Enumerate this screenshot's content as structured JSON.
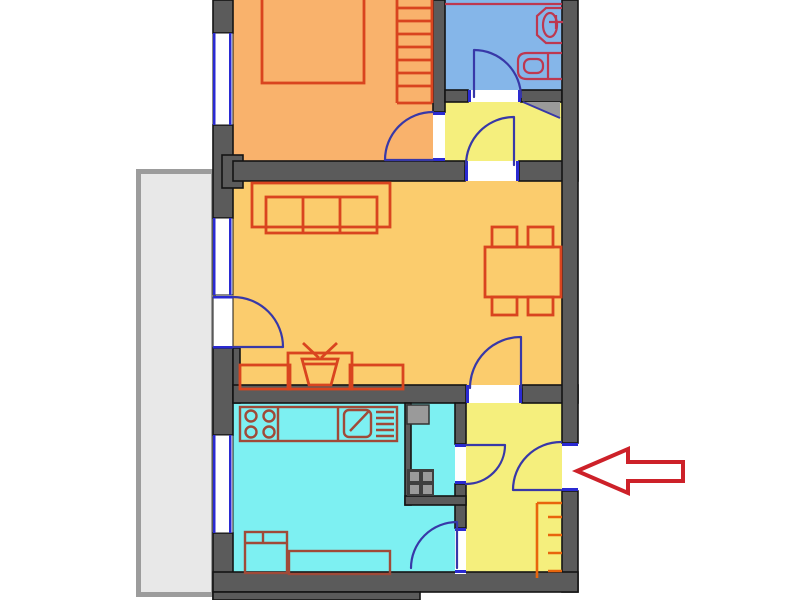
{
  "title": "apartment-floor-plan",
  "colors": {
    "white": "#ffffff",
    "wall": "#5b5b5b",
    "bedroom": "#f9b26c",
    "living": "#fbcc6d",
    "hall": "#f5ef7d",
    "bathroom": "#85b6e9",
    "kitchen": "#7df0f2",
    "balcony_fill": "#e8e8e8",
    "balcony_border": "#9c9c9c",
    "window_blue": "#2a2ad2",
    "door_blue": "#3838a8",
    "furniture_red": "#d9441f",
    "bath_fixture": "#bd3850",
    "kitchen_fixture": "#a04a38",
    "wardrobe_orange": "#e8650c",
    "arrow_red": "#cd2129",
    "shaft_gray": "#9a9a9a",
    "shaft_dark": "#3f3f3f"
  },
  "rooms": [
    {
      "id": "bedroom",
      "furniture": [
        "bed",
        "wardrobe-shelves"
      ]
    },
    {
      "id": "bathroom",
      "furniture": [
        "sink",
        "toilet"
      ]
    },
    {
      "id": "hallway-top",
      "furniture": [
        "corner-wedge"
      ]
    },
    {
      "id": "living-room",
      "furniture": [
        "sofa",
        "dining-table",
        "four-chairs",
        "tv-cabinet"
      ]
    },
    {
      "id": "kitchen",
      "furniture": [
        "stove",
        "counter",
        "sink",
        "dish-rack",
        "washing-machine",
        "bench",
        "vent-shaft"
      ]
    },
    {
      "id": "entrance-hall",
      "furniture": [
        "wardrobe-shelves"
      ]
    },
    {
      "id": "balcony",
      "furniture": []
    }
  ],
  "doors": [
    "bedroom-door",
    "bathroom-door",
    "hallway-living-door",
    "balcony-door",
    "living-hall-door",
    "closet-door",
    "kitchen-door",
    "entry-door"
  ],
  "annotation": {
    "arrow_direction": "left",
    "points_at": "entry-door"
  }
}
